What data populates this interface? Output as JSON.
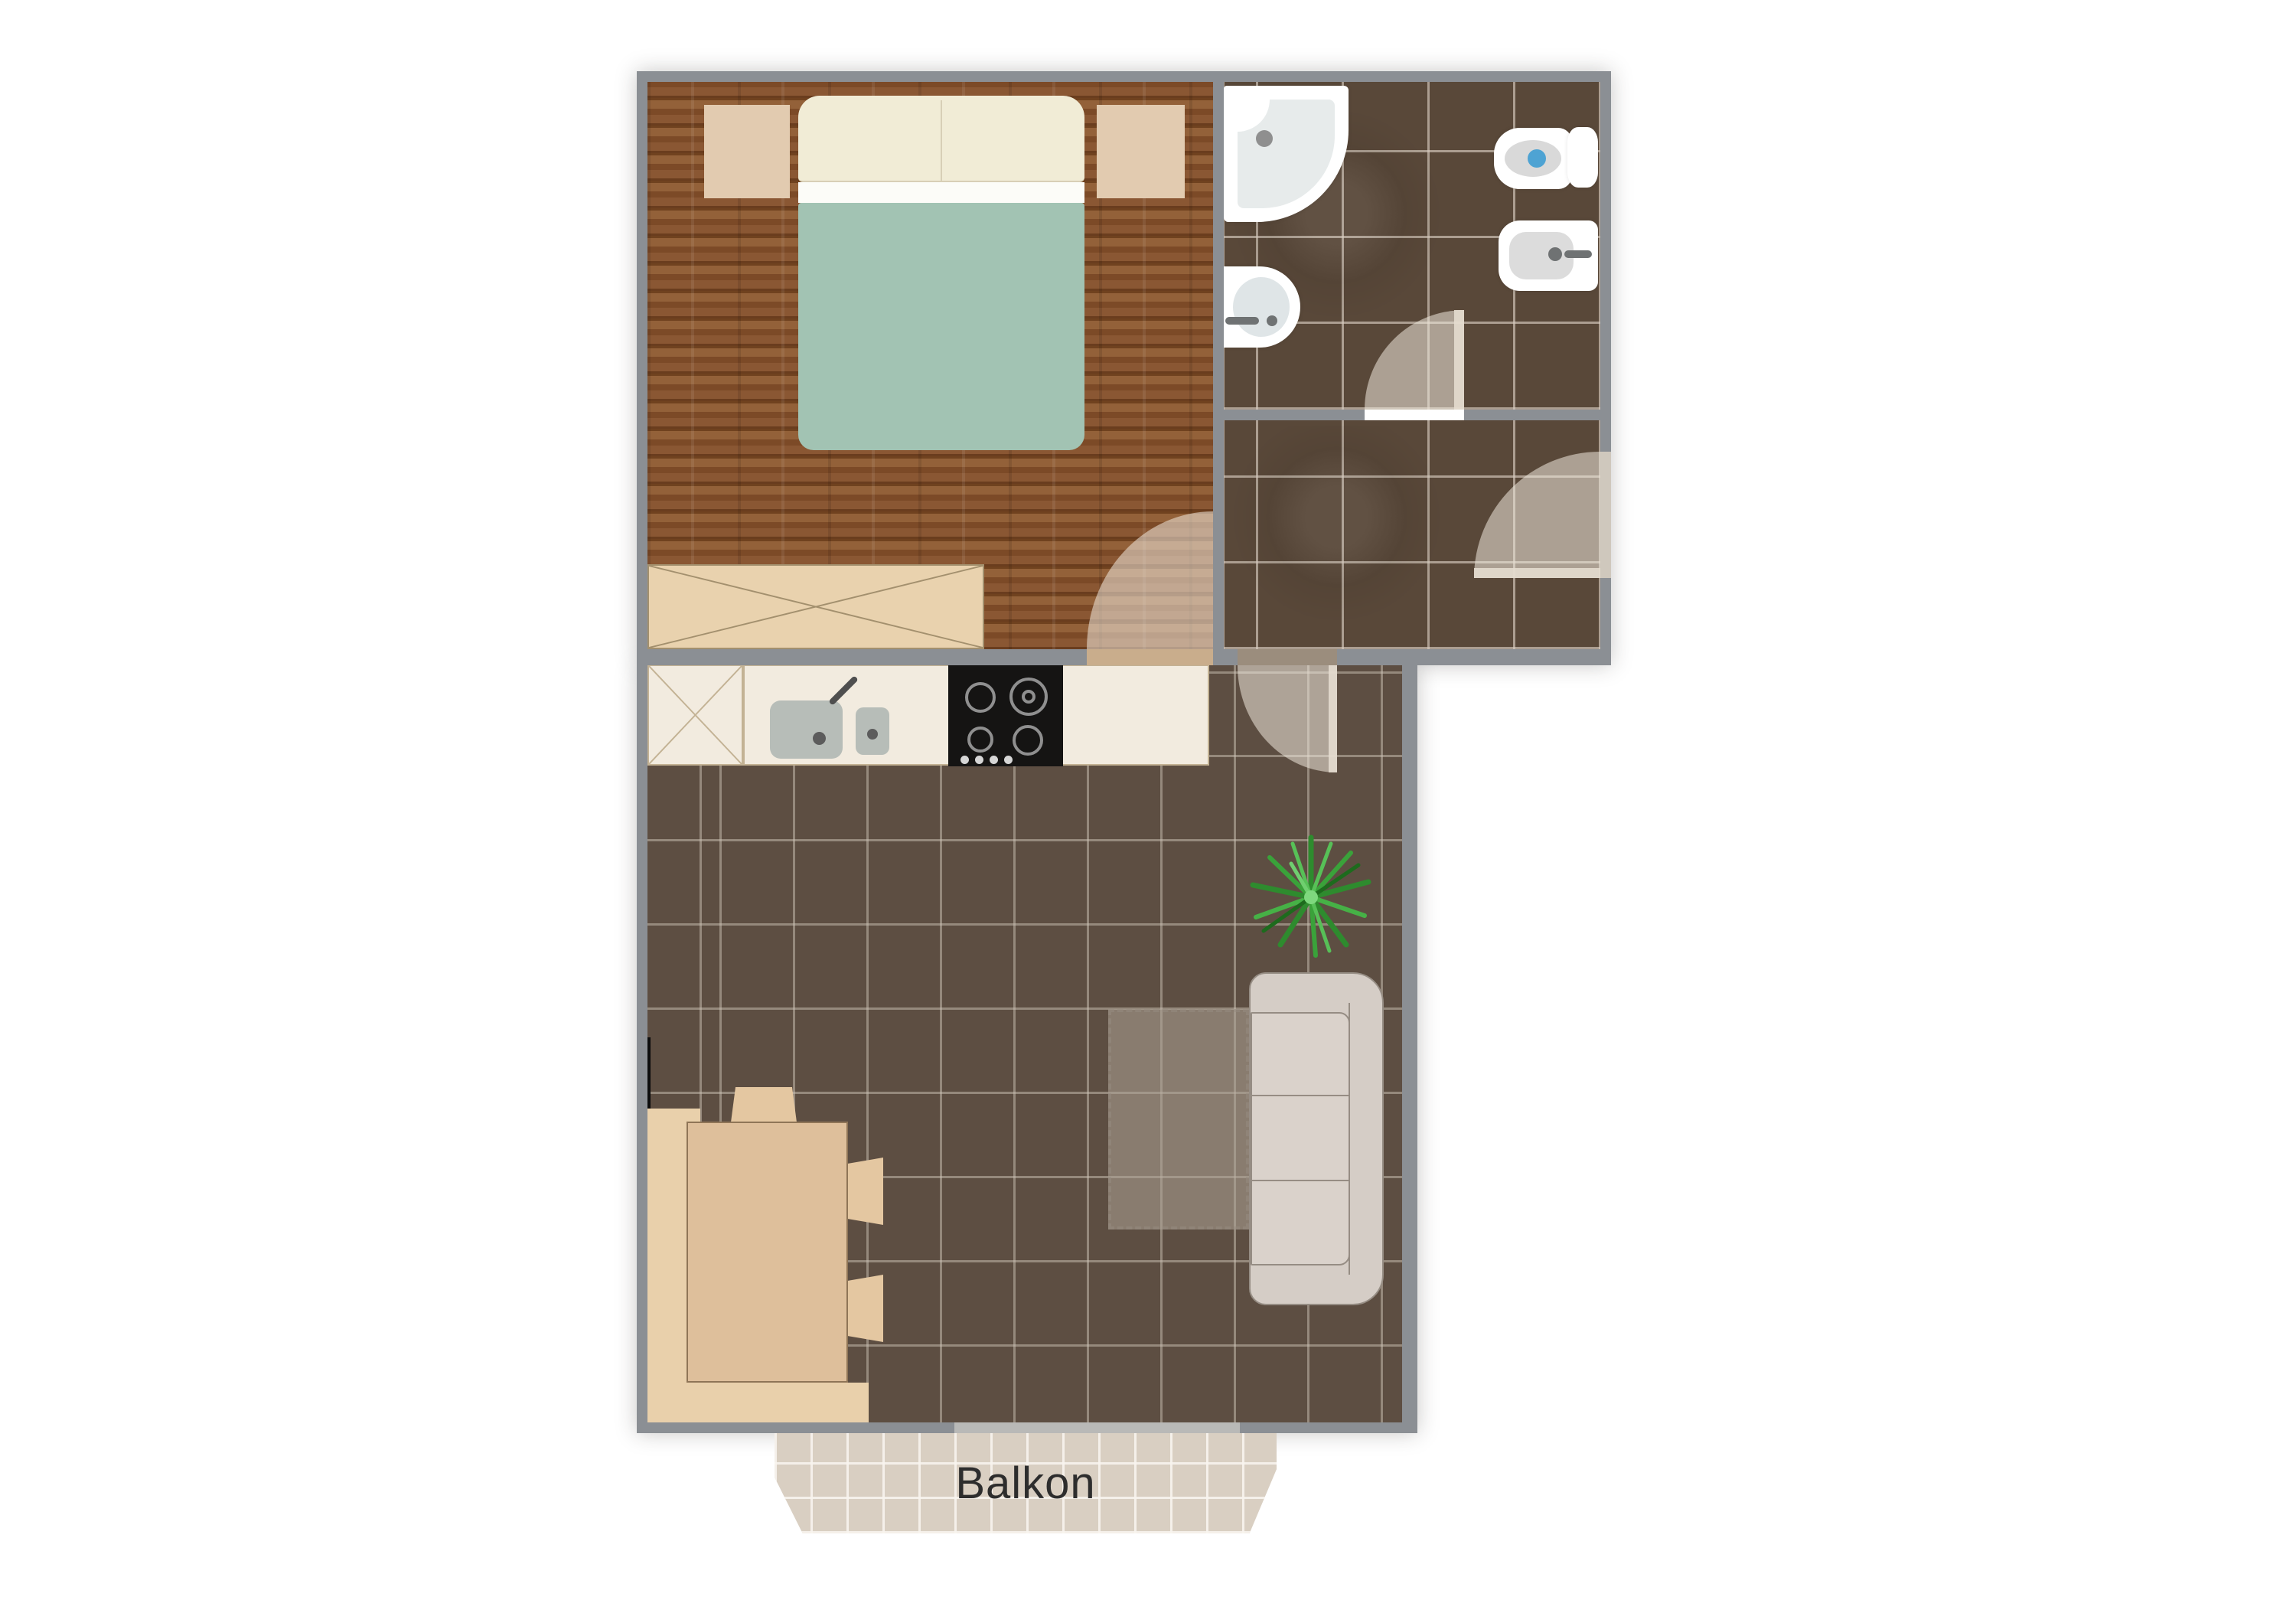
{
  "labels": {
    "balcony": "Balkon"
  },
  "rooms": [
    {
      "name": "bedroom",
      "floor": "wood"
    },
    {
      "name": "bathroom",
      "floor": "dark-tile"
    },
    {
      "name": "hallway",
      "floor": "dark-tile"
    },
    {
      "name": "kitchen-living-room",
      "floor": "brown-tile"
    },
    {
      "name": "balcony",
      "floor": "beige-tile",
      "label": "Balkon"
    }
  ],
  "fixtures": [
    "double-bed",
    "pillows",
    "nightstand-left",
    "nightstand-right",
    "wardrobe",
    "corner-shower",
    "washbasin",
    "toilet",
    "bidet",
    "kitchen-counter",
    "kitchen-sink",
    "cooktop-4-burners",
    "dining-corner-bench",
    "dining-table",
    "chairs",
    "sofa",
    "rug",
    "potted-plant",
    "door-swings",
    "radiator"
  ],
  "palette": {
    "wall": "#8b8f94",
    "wood_floor": "#80512d",
    "dark_tile": "#594839",
    "living_tile": "#5d4e42",
    "balcony_tile": "#d9cfc2",
    "counter_cream": "#f2ebdf",
    "furniture_beige": "#e8cfa9",
    "blanket_teal": "#a2c3b3",
    "sofa_grey": "#d5cdc6",
    "toilet_water_blue": "#4ea3d3",
    "plant_green": "#3aa23a",
    "cooktop_black": "#151413",
    "label_text": "#2d2d2d"
  }
}
